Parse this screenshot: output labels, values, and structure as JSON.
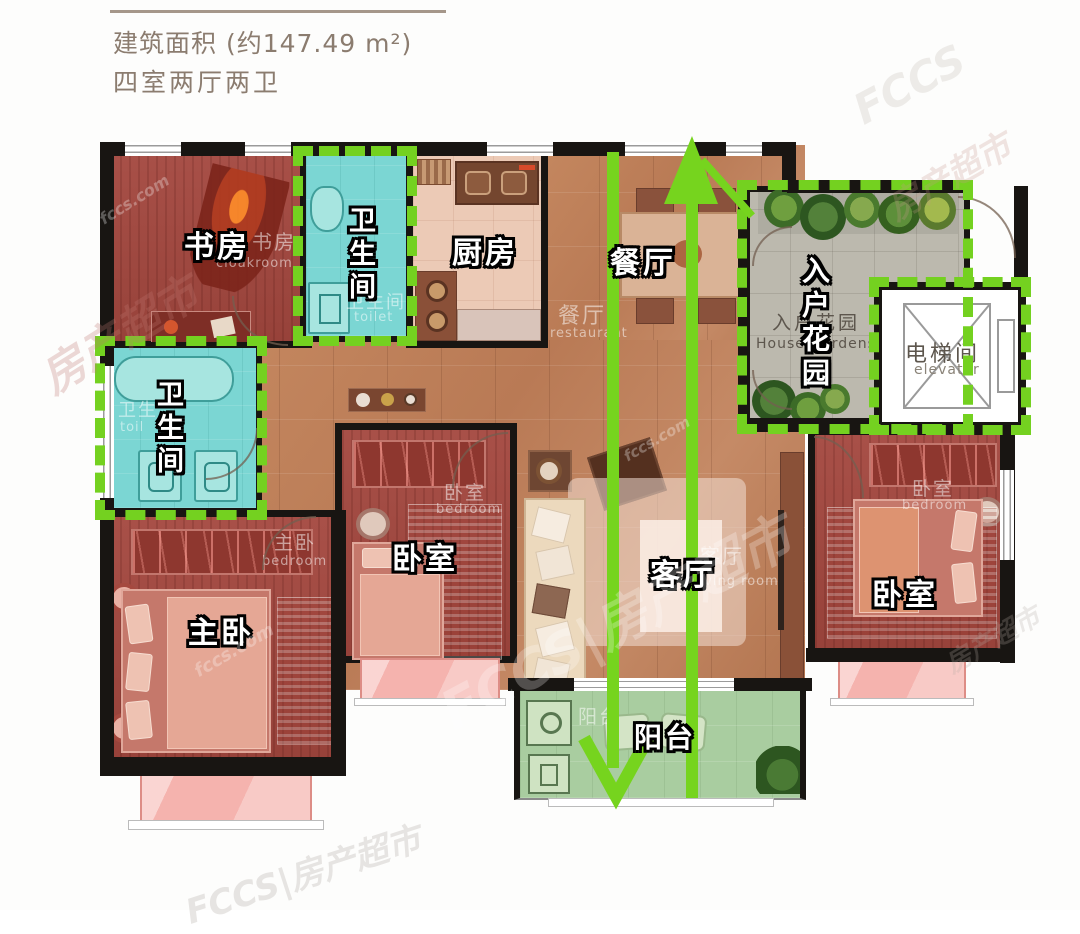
{
  "header": {
    "area_label": "建筑面积 (约147.49 m²)",
    "layout_label": "四室两厅两卫"
  },
  "rooms": {
    "study": {
      "label": "书房",
      "ghost_cn": "书房",
      "ghost_en": "cloakroom"
    },
    "toilet_top": {
      "label": "卫生间",
      "ghost_cn": "卫生间",
      "ghost_en": "toilet"
    },
    "kitchen": {
      "label": "厨房"
    },
    "dining": {
      "label": "餐厅",
      "ghost_cn": "餐厅",
      "ghost_en": "restaurant"
    },
    "entry_garden": {
      "label": "入户花园",
      "ghost_cn": "入户花园",
      "ghost_en": "House Gardens"
    },
    "elevator": {
      "label": "电梯间",
      "ghost_en": "elevator"
    },
    "toilet_left": {
      "label": "卫生间",
      "ghost_cn": "卫生",
      "ghost_en": "toil"
    },
    "master_bedroom": {
      "label": "主卧",
      "ghost_cn": "主卧",
      "ghost_en": "bedroom"
    },
    "bedroom_middle": {
      "label": "卧室",
      "ghost_cn": "卧室",
      "ghost_en": "bedroom"
    },
    "living": {
      "label": "客厅",
      "ghost_cn": "客厅",
      "ghost_en": "living room"
    },
    "bedroom_right": {
      "label": "卧室",
      "ghost_cn": "卧室",
      "ghost_en": "bedroom"
    },
    "balcony": {
      "label": "阳台",
      "ghost_cn": "阳台"
    }
  },
  "watermark": {
    "brand": "FCCS",
    "name": "房产超市",
    "full": "FCCS|房产超市",
    "domain": "fccs.com"
  },
  "colors": {
    "highlight_green": "#74d120",
    "arrow_green": "#76d41e",
    "bathroom_cyan": "#7bd6d3",
    "bedroom_red": "#a04a41",
    "floor_terracotta": "#bd7f5c",
    "kitchen_beige": "#eccab6",
    "balcony_green": "#a9cda0",
    "garden_gray": "#bcb9ae",
    "bay_window_pink": "#f5b3ae",
    "wall_black": "#181512"
  }
}
